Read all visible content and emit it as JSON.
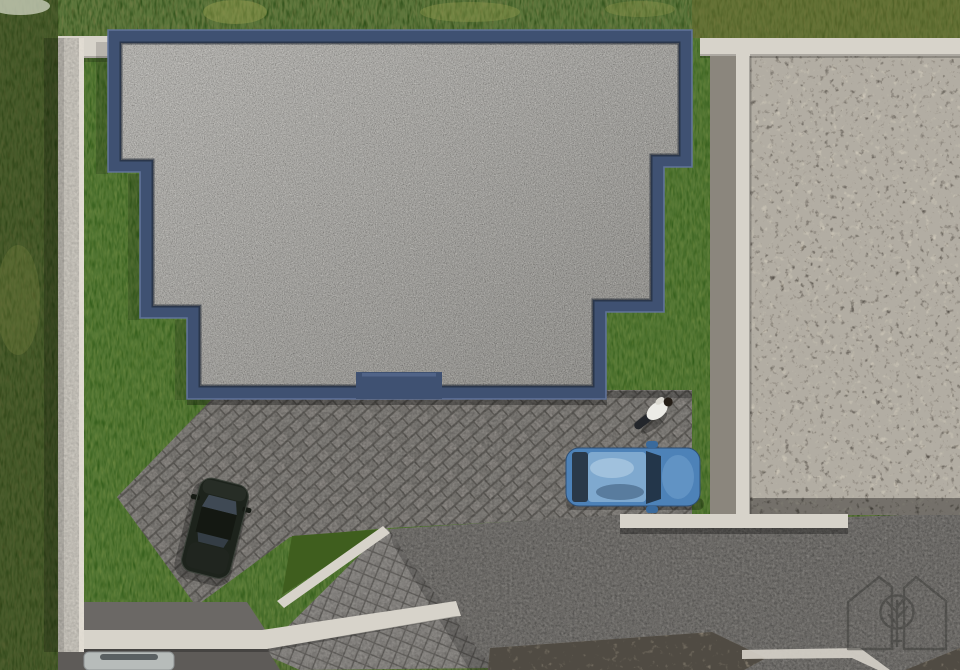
{
  "meta": {
    "title": "Aerial top-down 3D architectural render of a modern flat-roof house plot",
    "view": "top-down drone view"
  },
  "colors": {
    "wild_grass": "#4a5422",
    "wild_grass_dark": "#2f3a16",
    "grass_olive": "#6b6d2f",
    "bush_light": "#9aa050",
    "corner_bush": "#c8cdb9",
    "lawn": "#4e6f26",
    "lawn_dark": "#3f5e1e",
    "parapet": "#3f5172",
    "parapet_light": "#64779e",
    "parapet_dark": "#1c2532",
    "roof_gravel": "#bcb8b3",
    "wall": "#d7d3ca",
    "wall_shadow": "#8b867d",
    "neighbor_gravel": "#a39988",
    "paver_joint": "#6f6c67",
    "cobble": "#9c9995",
    "concrete": "#7e7b77",
    "asphalt": "#6b6865",
    "asphalt_dark": "#5e5b58",
    "car_dark": "#1d231c",
    "car_blue": "#4d82b8",
    "car_blue_roof": "#7fa9cf",
    "car_silver": "#b7bcba",
    "person_shirt": "#ecebe6",
    "person_dark": "#23262b",
    "logo": "#3e3e3b"
  },
  "objects": {
    "building_roof": "flat gravel roof with navy parapet",
    "left_boundary_wall": "concrete boundary wall (left)",
    "top_boundary_wall": "concrete boundary wall (top)",
    "right_boundary_wall": "concrete boundary wall (right)",
    "t_wall": "concrete dividing wall",
    "bottom_wall": "street-side retaining wall",
    "neighbor_yard": "neighboring plot covered in coarse gravel",
    "driveway_pavers": "herringbone paver driveway",
    "concrete_driveway": "concrete driveway area",
    "street_cobbles": "cobble paved street wedge",
    "street": "asphalt street strip",
    "lawn": "mown green lawn",
    "wild_grass": "unmown grass outside the walls",
    "dark_car": "dark SUV parked on the paver driveway",
    "blue_car": "blue car parked along the wall",
    "silver_car": "silver car partially visible at bottom edge",
    "person": "person walking on the walkway",
    "logo": "architect watermark logo (two houses and a tree)"
  }
}
